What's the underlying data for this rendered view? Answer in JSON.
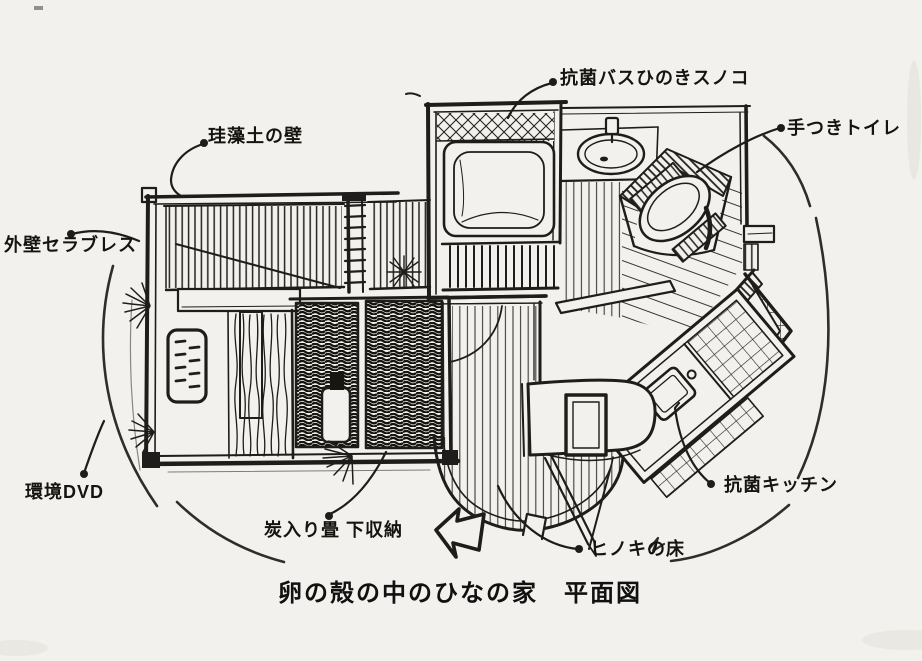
{
  "title": "卵の殻の中のひなの家　平面図",
  "labels": {
    "bath": "抗菌バスひのきスノコ",
    "toilet": "手つきトイレ",
    "diatomite_wall": "珪藻土の壁",
    "exterior_wall": "外壁セラブレス",
    "dvd": "環境DVD",
    "storage": "炭入り畳 下収納",
    "hinoki_floor": "ヒノキの床",
    "kitchen": "抗菌キッチン"
  },
  "colors": {
    "ink": "#1e1d1b",
    "paper": "#f2f1ed"
  },
  "icons": {
    "entrance_arrow": "block-arrow-up-left"
  }
}
